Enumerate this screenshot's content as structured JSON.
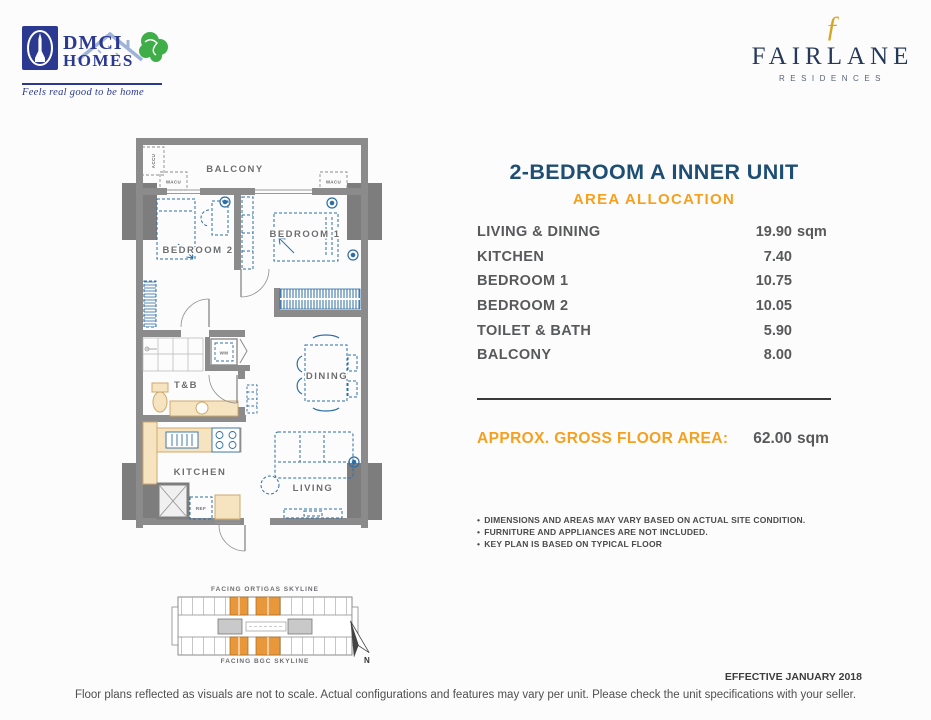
{
  "header": {
    "dmci": {
      "name": "DMCI",
      "homes": "HOMES",
      "tagline": "Feels real good to be home"
    },
    "fairlane": {
      "monogram": "ƒ",
      "name": "FAIRLANE",
      "sub": "RESIDENCES"
    }
  },
  "unit": {
    "title": "2-BEDROOM A INNER UNIT",
    "section": "AREA ALLOCATION",
    "rows": [
      {
        "label": "LIVING & DINING",
        "value": "19.90",
        "unit": "sqm"
      },
      {
        "label": "KITCHEN",
        "value": "7.40",
        "unit": ""
      },
      {
        "label": "BEDROOM 1",
        "value": "10.75",
        "unit": ""
      },
      {
        "label": "BEDROOM 2",
        "value": "10.05",
        "unit": ""
      },
      {
        "label": "TOILET & BATH",
        "value": "5.90",
        "unit": ""
      },
      {
        "label": "BALCONY",
        "value": "8.00",
        "unit": ""
      }
    ],
    "gross": {
      "label": "APPROX. GROSS FLOOR AREA:",
      "value": "62.00",
      "unit": "sqm"
    },
    "notes": [
      "DIMENSIONS AND AREAS MAY VARY BASED ON ACTUAL SITE CONDITION.",
      "FURNITURE AND APPLIANCES ARE NOT INCLUDED.",
      "KEY PLAN IS BASED ON TYPICAL FLOOR"
    ]
  },
  "floorplan": {
    "labels": {
      "balcony": "BALCONY",
      "bedroom1": "BEDROOM 1",
      "bedroom2": "BEDROOM 2",
      "tb": "T&B",
      "dining": "DINING",
      "kitchen": "KITCHEN",
      "living": "LIVING",
      "wm": "WM",
      "ref": "REF",
      "wacu": "WACU",
      "accu": "ACCU"
    }
  },
  "keyplan": {
    "top": "FACING ORTIGAS SKYLINE",
    "bottom": "FACING BGC SKYLINE",
    "north": "N"
  },
  "footer": {
    "effective": "EFFECTIVE JANUARY 2018",
    "disclaimer": "Floor plans reflected as visuals are not to scale. Actual configurations and features may vary per unit. Please check the unit specifications with your seller."
  },
  "colors": {
    "navy": "#1f4e74",
    "orange": "#f5a01e",
    "dmci_blue": "#2b3990",
    "fairlane_gold": "#d9a527",
    "wall_gray": "#8b8b8b",
    "furniture_blue": "#2e6da5",
    "fixture_beige": "#f6e3c0",
    "keyplan_unit_orange": "#e8973a",
    "table_text": "#58595b"
  }
}
